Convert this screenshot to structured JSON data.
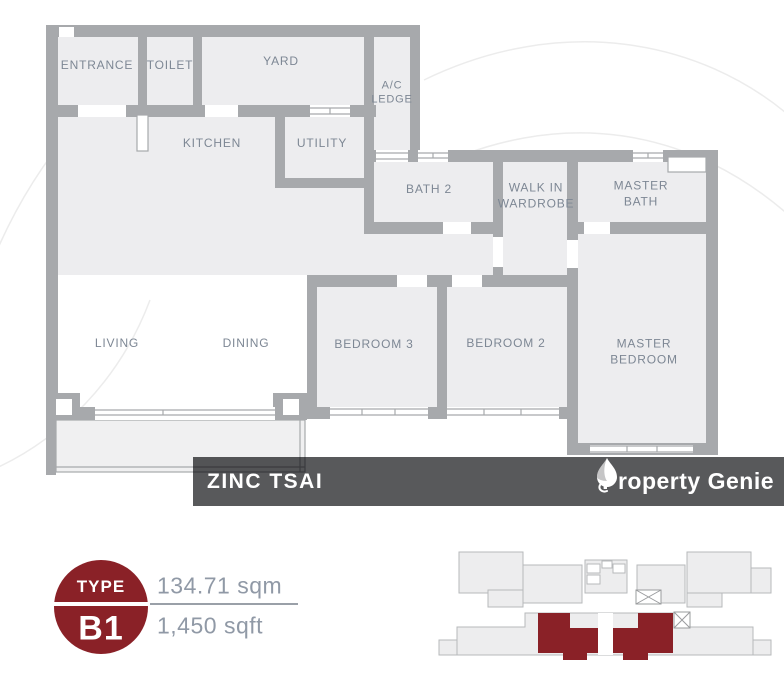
{
  "floor_plan": {
    "rooms": {
      "entrance": {
        "label": "ENTRANCE"
      },
      "toilet": {
        "label": "TOILET"
      },
      "yard": {
        "label": "YARD"
      },
      "ac_ledge": {
        "label": "A/C LEDGE"
      },
      "kitchen": {
        "label": "KITCHEN"
      },
      "utility": {
        "label": "UTILITY"
      },
      "bath2": {
        "label": "BATH 2"
      },
      "walk_in_wardrobe": {
        "label": "WALK IN WARDROBE"
      },
      "master_bath": {
        "label": "MASTER BATH"
      },
      "living": {
        "label": "LIVING"
      },
      "dining": {
        "label": "DINING"
      },
      "bedroom3": {
        "label": "BEDROOM 3"
      },
      "bedroom2": {
        "label": "BEDROOM 2"
      },
      "master_bedroom": {
        "label": "MASTER BEDROOM"
      }
    }
  },
  "banner": {
    "project_name": "ZINC TSAI",
    "brand_name": "Property Genie",
    "brand_icon": "flame-icon"
  },
  "unit_info": {
    "type_label": "TYPE",
    "type_code": "B1",
    "area_sqm": "134.71 sqm",
    "area_sqft": "1,450 sqft"
  },
  "colors": {
    "accent_red": "#8A2127",
    "wall_gray": "#A7A9AC",
    "room_fill": "#EDEDEF",
    "banner_gray": "#58595B",
    "label_gray": "#7D8794"
  }
}
